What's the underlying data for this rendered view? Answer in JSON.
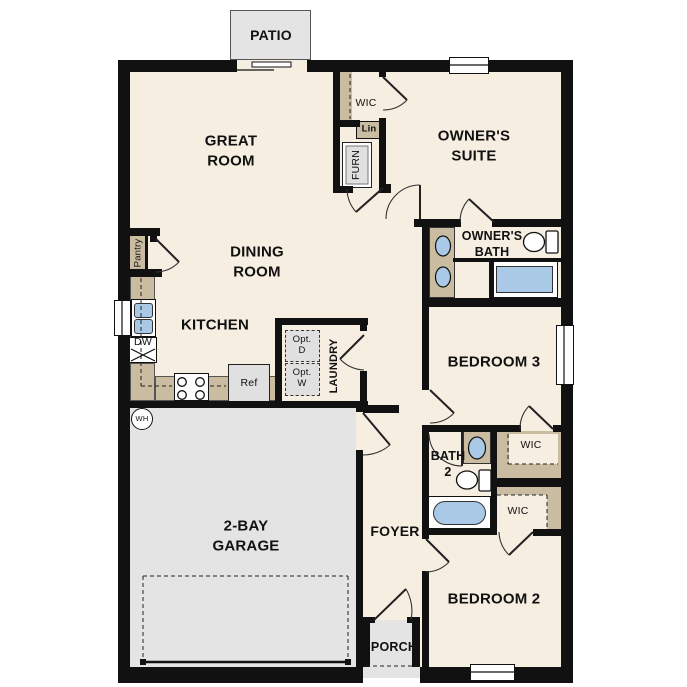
{
  "plan": {
    "patio": "PATIO",
    "great_room": "GREAT\nROOM",
    "dining_room": "DINING\nROOM",
    "kitchen": "KITCHEN",
    "owners_suite": "OWNER'S\nSUITE",
    "owners_bath": "OWNER'S\nBATH",
    "wic_owner": "WIC",
    "lin": "Lin",
    "furn": "FURN",
    "pantry": "Pantry",
    "dw": "DW",
    "ref": "Ref",
    "opt_d": "Opt.\nD",
    "opt_w": "Opt.\nW",
    "laundry": "LAUNDRY",
    "wh": "WH",
    "bedroom3": "BEDROOM 3",
    "bedroom2": "BEDROOM 2",
    "bath2": "BATH\n2",
    "garage": "2-BAY\nGARAGE",
    "foyer": "FOYER",
    "porch": "PORCH",
    "wic_bed3": "WIC",
    "wic_bed2": "WIC"
  },
  "colors": {
    "wall": "#111111",
    "floor": "#f6eee1",
    "garage": "#e4e4e4",
    "casework": "#c9bca0",
    "blue": "#a9c9e6",
    "appliance": "#e0e0e0",
    "outside": "#ffffff",
    "text": "#111111"
  }
}
